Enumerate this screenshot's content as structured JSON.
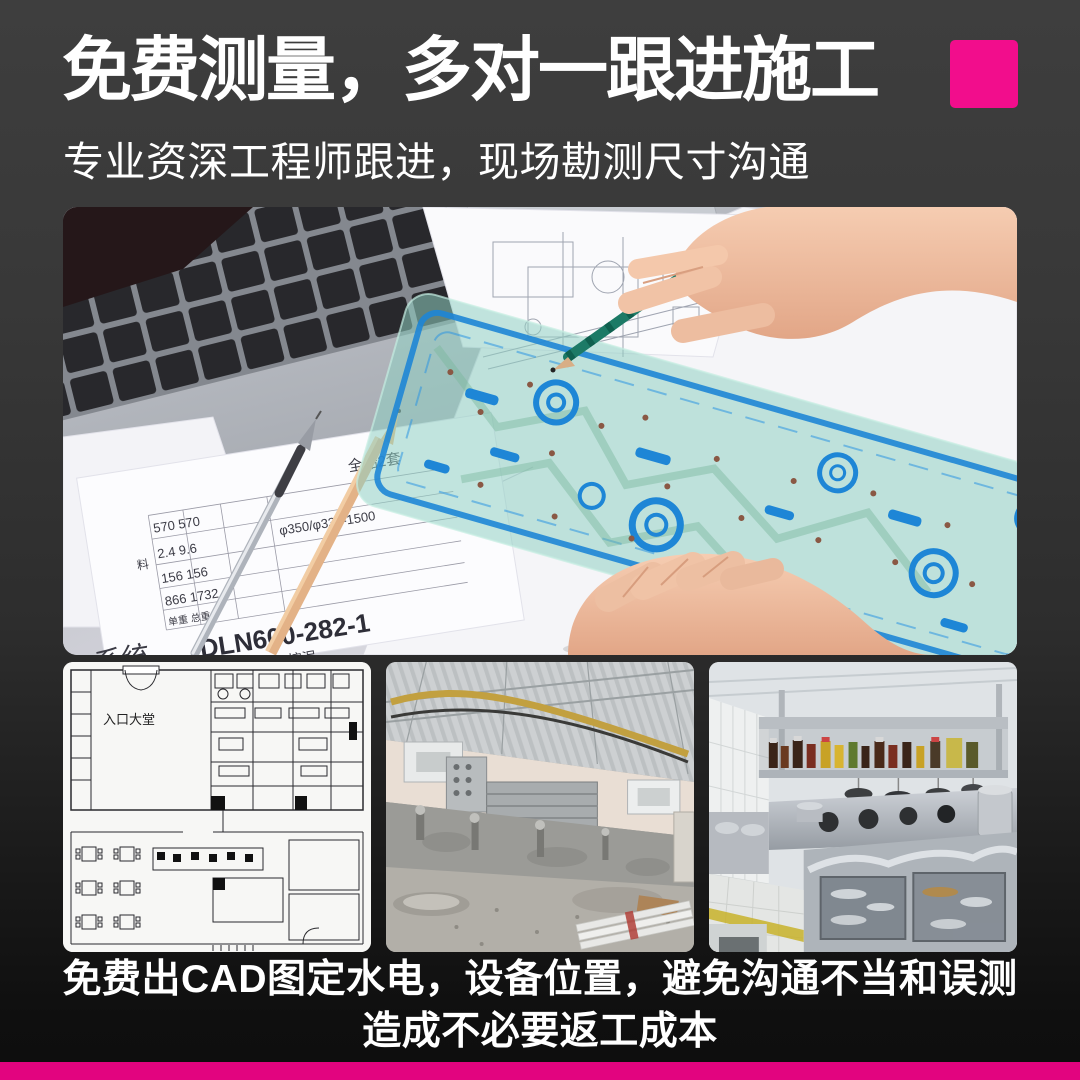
{
  "theme": {
    "background_top": "#3E3E3E",
    "background_bottom": "#0E0E0E",
    "accent_pink": "#F20D8C",
    "bottom_bar_pink": "#E2047F",
    "text_color": "#FFFFFF"
  },
  "header": {
    "title": "免费测量，多对一跟进施工",
    "subtitle": "专业资深工程师跟进，现场勘测尺寸沟通"
  },
  "hero": {
    "drawing_table": {
      "set_label": "全船2套",
      "row1": "570  570",
      "row2": "2.4  9.6",
      "spec": "φ350/φ330-1500",
      "row3": "156  156",
      "row4": "866  1732",
      "weight_labels": "单重 总重",
      "material_label": "料",
      "part_no": "DLN600-282-1",
      "project": "6000M3挖泥",
      "system_label": "系统"
    }
  },
  "gallery": {
    "cad_plan": {
      "lobby_label": "入口大堂"
    }
  },
  "caption": {
    "line1": "免费出CAD图定水电，设备位置，避免沟通不当和误测",
    "line2": "造成不必要返工成本"
  }
}
